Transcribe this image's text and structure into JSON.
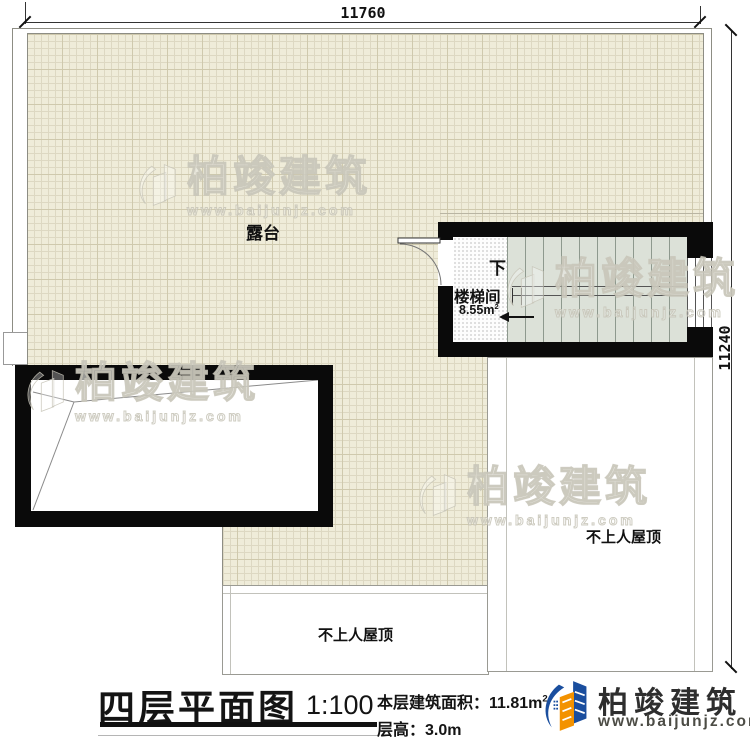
{
  "dimensions": {
    "top": "11760",
    "right": "11240"
  },
  "plan": {
    "terrace_label": "露台",
    "stair": {
      "down": "下",
      "room": "楼梯间",
      "area_value": "8.55m",
      "area_sup": "2"
    },
    "roof_right_label": "不上人屋顶",
    "roof_bottom_label": "不上人屋顶"
  },
  "title_block": {
    "title": "四层平面图",
    "scale": "1:100",
    "area_label": "本层建筑面积：",
    "area_value": "11.81m",
    "area_sup": "2",
    "floor_height_label": "层高：",
    "floor_height_value": "3.0m"
  },
  "brand": {
    "name": "柏竣建筑",
    "url": "www.baijunjz.com"
  },
  "watermark": {
    "name": "柏竣建筑",
    "url": "www.baijunjz.com"
  },
  "icons": {
    "brand_logo": "building-swoosh-icon"
  },
  "colors": {
    "wall": "#0a0a0a",
    "terrace_bg": "#efecd9",
    "grid_line": "#cfc9ad",
    "stair_tread_bg": "#dce1d8",
    "roof_border": "#9a9a93",
    "brand_blue": "#1a4e9e",
    "brand_orange": "#f39200"
  }
}
